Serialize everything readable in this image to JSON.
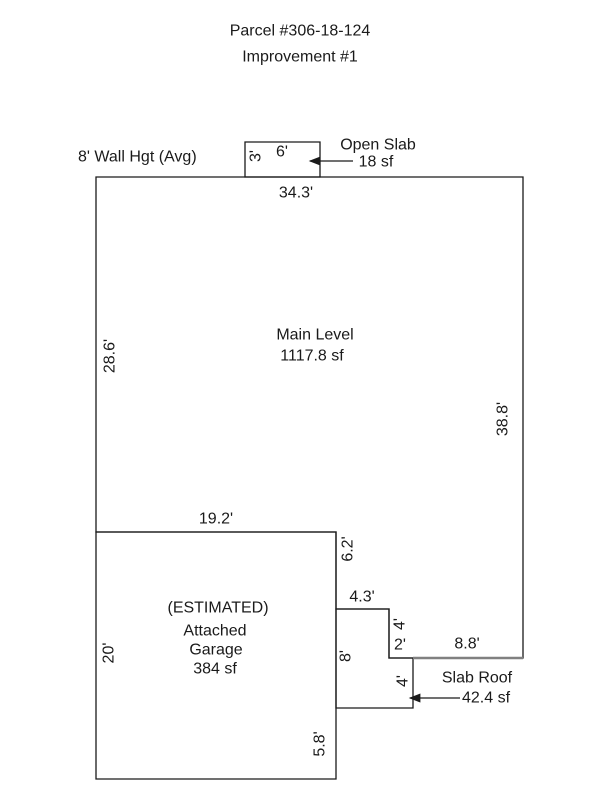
{
  "header": {
    "parcel_title": "Parcel #306-18-124",
    "improvement_title": "Improvement #1"
  },
  "sketch": {
    "wall_height_note": "8' Wall Hgt (Avg)",
    "areas": {
      "open_slab": {
        "name": "Open Slab",
        "area": "18 sf"
      },
      "main_level": {
        "name": "Main Level",
        "area": "1117.8 sf"
      },
      "garage": {
        "qualifier": "(ESTIMATED)",
        "name_line1": "Attached",
        "name_line2": "Garage",
        "area": "384 sf"
      },
      "slab_roof": {
        "name": "Slab Roof",
        "area": "42.4 sf"
      }
    },
    "dimensions": {
      "open_slab_height": "3'",
      "open_slab_width": "6'",
      "main_top": "34.3'",
      "main_left": "28.6'",
      "main_right": "38.8'",
      "main_bottom": "8.8'",
      "garage_top": "19.2'",
      "garage_left": "20'",
      "garage_right_upper": "6.2'",
      "garage_right_mid": "8'",
      "garage_right_lower": "5.8'",
      "slab_roof_top": "4.3'",
      "slab_roof_right_upper": "4'",
      "slab_roof_right_lower": "4'",
      "notch_bottom": "2'"
    },
    "colors": {
      "outline": "#000000",
      "text": "#000000",
      "accent_line": "#808080",
      "background": "#ffffff"
    }
  }
}
